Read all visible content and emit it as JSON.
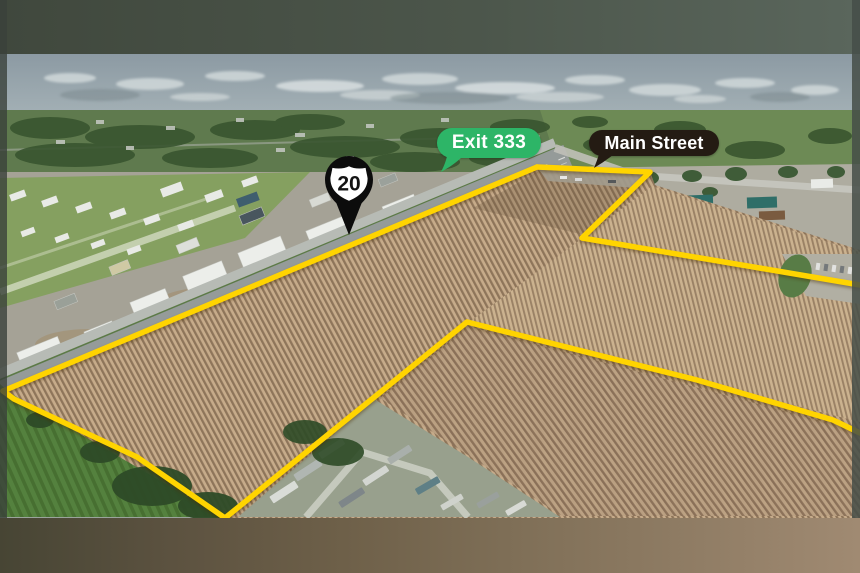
{
  "photo": {
    "description": "Aerial view of plowed farmland parcels outlined in yellow beside a divided highway, with an airport, industrial buildings, a mobile home park and commercial development surrounding the fields"
  },
  "overlays": {
    "exit_badge": {
      "label": "Exit 333",
      "bg_color": "#2db567",
      "text_color": "#ffffff"
    },
    "street_badge": {
      "label": "Main Street",
      "bg_color": "#241b13",
      "text_color": "#ffffff"
    },
    "route_pin": {
      "number": "20",
      "pin_color": "#0c0c0c",
      "shield_color": "#ffffff"
    }
  },
  "boundary": {
    "color": "#ffd400",
    "segments": {
      "highway_edge": "3,391 537,167",
      "north_parcel": "537,167 650,172 582,238 860,285",
      "west_edge": "3,391 14,399 137,457 225,518",
      "south_edge": "225,518 467,322 697,380 833,420 860,433"
    }
  }
}
